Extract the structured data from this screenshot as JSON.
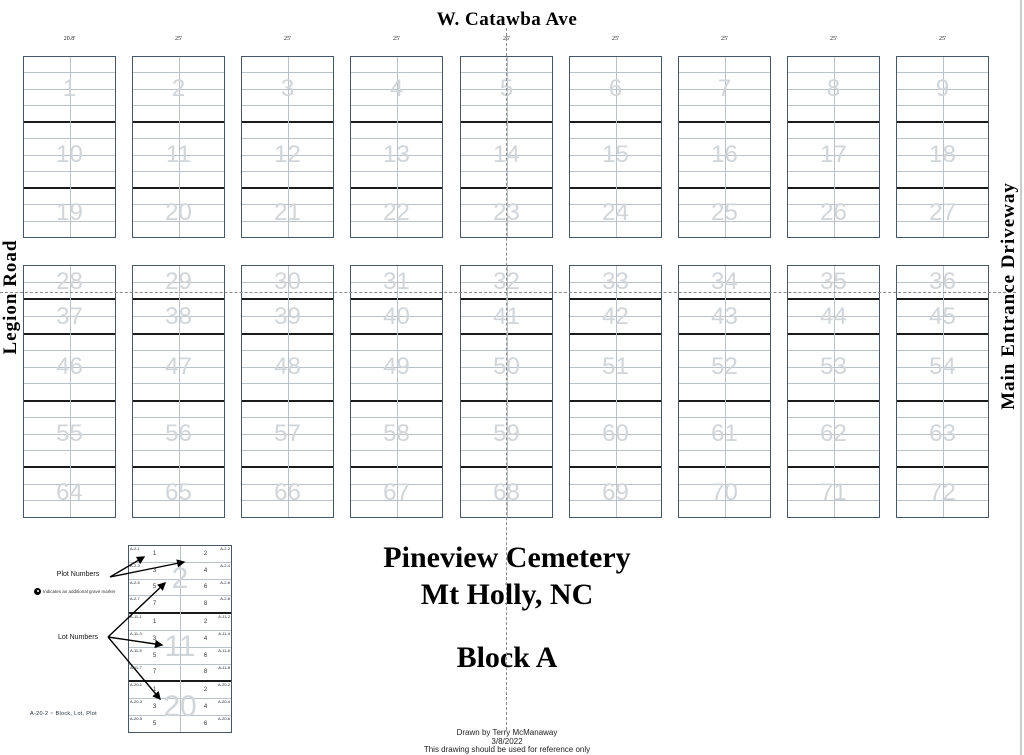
{
  "roads": {
    "top": "W. Catawba Ave",
    "left": "Legion Road",
    "right": "Main Entrance Driveway"
  },
  "titles": {
    "cemetery": "Pineview Cemetery",
    "city": "Mt Holly, NC",
    "block": "Block A"
  },
  "footer": {
    "drawn_by": "Drawn by Terry McManaway",
    "date": "3/8/2022",
    "note": "This drawing should be used for reference only"
  },
  "map": {
    "measurements": [
      "20.8'",
      "25'",
      "25'",
      "25'",
      "25'",
      "25'",
      "25'",
      "25'",
      "25'"
    ],
    "bands": [
      {
        "lot_rows": [
          {
            "rows": 4,
            "lots": [
              1,
              2,
              3,
              4,
              5,
              6,
              7,
              8,
              9
            ]
          },
          {
            "rows": 4,
            "lots": [
              10,
              11,
              12,
              13,
              14,
              15,
              16,
              17,
              18
            ]
          },
          {
            "rows": 3,
            "lots": [
              19,
              20,
              21,
              22,
              23,
              24,
              25,
              26,
              27
            ]
          }
        ]
      },
      {
        "lot_rows": [
          {
            "rows": 2,
            "lots": [
              28,
              29,
              30,
              31,
              32,
              33,
              34,
              35,
              36
            ]
          },
          {
            "rows": 2,
            "lots": [
              37,
              38,
              39,
              40,
              41,
              42,
              43,
              44,
              45
            ]
          },
          {
            "rows": 4,
            "lots": [
              46,
              47,
              48,
              49,
              50,
              51,
              52,
              53,
              54
            ]
          },
          {
            "rows": 4,
            "lots": [
              55,
              56,
              57,
              58,
              59,
              60,
              61,
              62,
              63
            ]
          },
          {
            "rows": 3,
            "lots": [
              64,
              65,
              66,
              67,
              68,
              69,
              70,
              71,
              72
            ]
          }
        ]
      }
    ]
  },
  "legend": {
    "plot_numbers_label": "Plot Numbers",
    "lot_numbers_label": "Lot Numbers",
    "marker_note": "Indicates an additional grave marker",
    "code_note": "A-20-2 ~ Block, Lot, Plot",
    "example_lots": [
      {
        "lot": 2,
        "rows": 4,
        "plots": [
          1,
          2,
          3,
          4,
          5,
          6,
          7,
          8
        ],
        "codes": [
          "A-2-1",
          "A-2-2",
          "A-2-3",
          "A-2-4",
          "A-2-5",
          "A-2-6",
          "A-2-7",
          "A-2-8"
        ]
      },
      {
        "lot": 11,
        "rows": 4,
        "plots": [
          1,
          2,
          3,
          4,
          5,
          6,
          7,
          8
        ],
        "codes": [
          "A-11-1",
          "A-11-2",
          "A-11-3",
          "A-11-4",
          "A-11-5",
          "A-11-6",
          "A-11-7",
          "A-11-8"
        ]
      },
      {
        "lot": 20,
        "rows": 3,
        "plots": [
          1,
          2,
          3,
          4,
          5,
          6
        ],
        "codes": [
          "A-20-1",
          "A-20-2",
          "A-20-3",
          "A-20-4",
          "A-20-5",
          "A-20-6"
        ]
      }
    ]
  },
  "colors": {
    "block_border": "#46566b",
    "row_line": "#b9c1c9",
    "lot_separator": "#1b1b1b",
    "lot_number_watermark": "#d0d5da",
    "dashed_line": "#8a8a8a"
  }
}
